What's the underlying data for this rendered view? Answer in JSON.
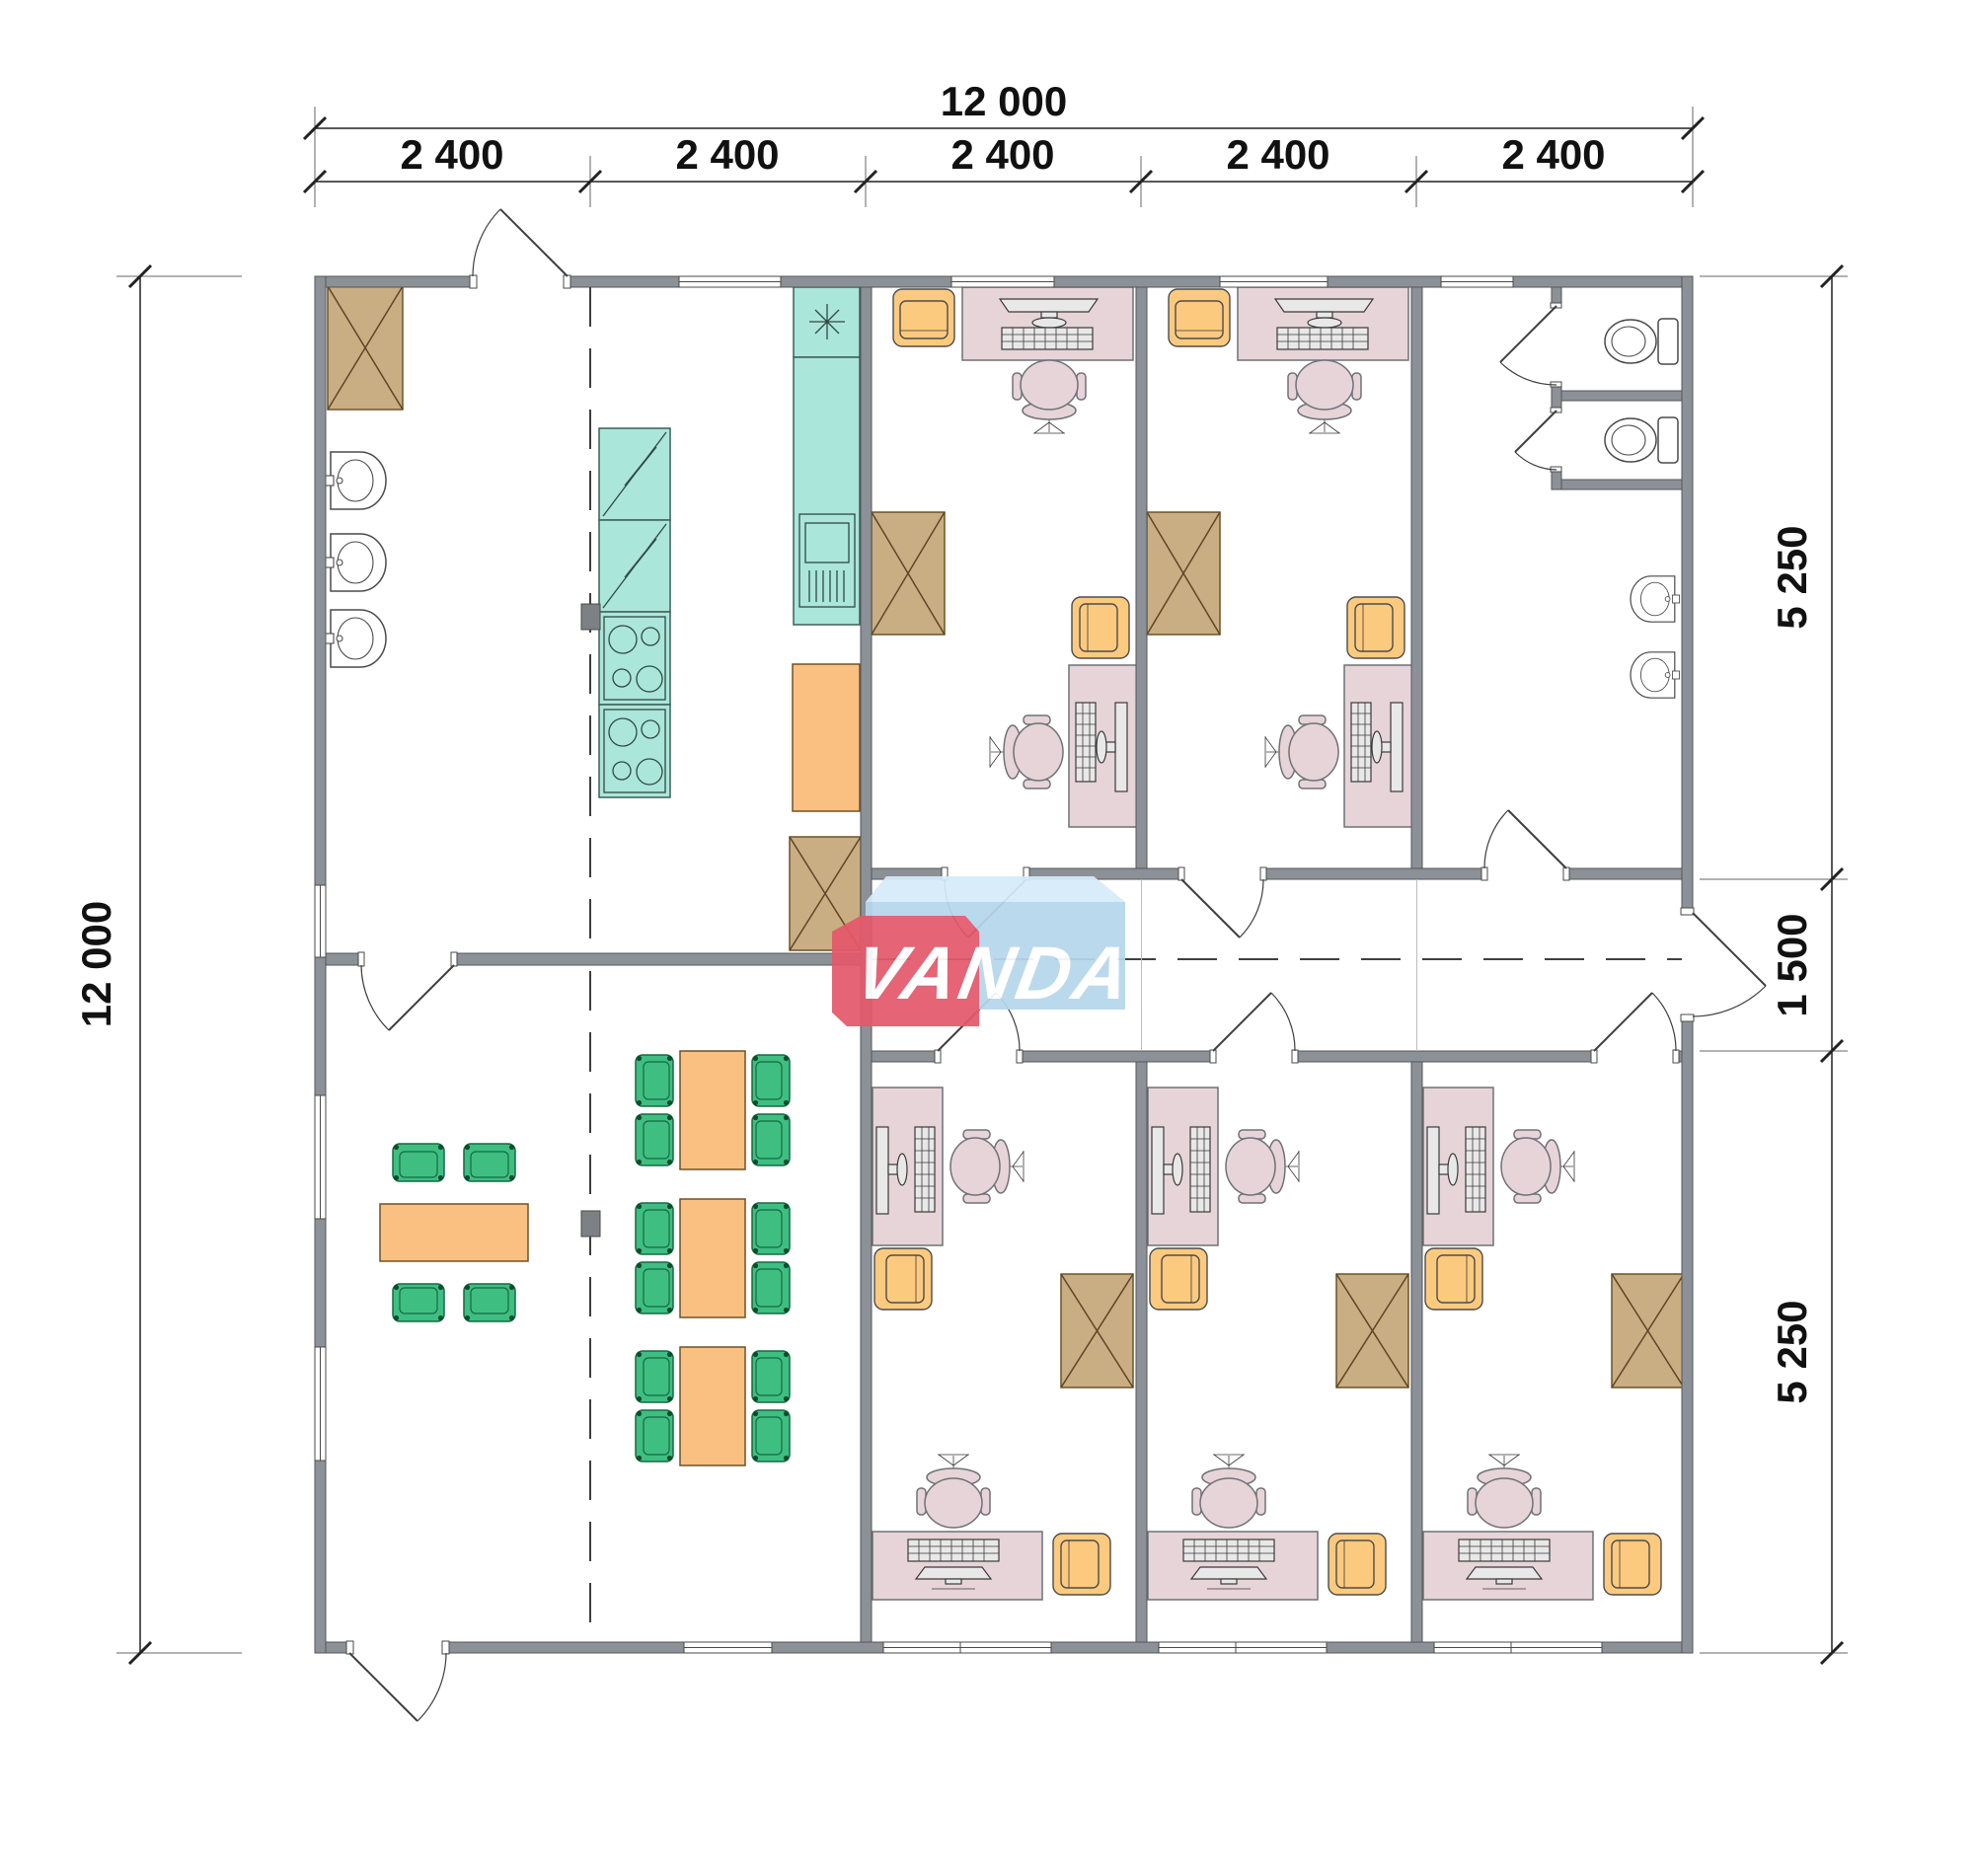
{
  "logo": {
    "text": "VANDA",
    "red": "#e4596b",
    "blue": "#b6d7eb",
    "light_blue": "#d6ebf9"
  },
  "dimensions": {
    "top_total": "12 000",
    "top_segments": [
      "2 400",
      "2 400",
      "2 400",
      "2 400",
      "2 400"
    ],
    "left_total": "12 000",
    "right_segments": [
      "5 250",
      "1 500",
      "5 250"
    ]
  },
  "colors": {
    "wall": "#8c9197",
    "cabinet_tan": "#c9ae84",
    "kitchen_teal": "#abe6da",
    "desk_pink": "#e6d4d9",
    "armchair_yellow": "#fcca7f",
    "table_orange": "#fac081",
    "chair_green": "#3fbe82"
  }
}
